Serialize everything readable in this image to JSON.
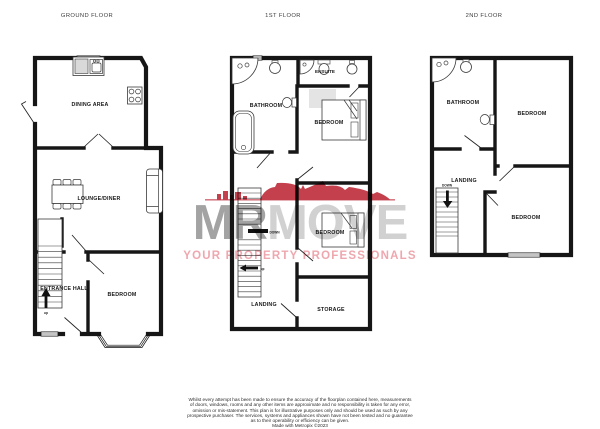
{
  "titles": {
    "ground": "GROUND FLOOR",
    "first": "1ST FLOOR",
    "second": "2ND FLOOR"
  },
  "ground": {
    "dining": "DINING AREA",
    "lounge": "LOUNGE/DINER",
    "hall": "ENTRANCE HALL",
    "bedroom": "BEDROOM",
    "up": "up"
  },
  "first": {
    "bathroom": "BATHROOM",
    "ensuite": "ENSUITE",
    "bedroom_top": "BEDROOM",
    "bedroom_mid": "BEDROOM",
    "landing": "LANDING",
    "storage": "STORAGE",
    "down": "DOWN",
    "up": "up"
  },
  "second": {
    "bathroom": "BATHROOM",
    "bedroom_top": "BEDROOM",
    "landing": "LANDING",
    "bedroom_bottom": "BEDROOM",
    "down": "DOWN"
  },
  "watermark": {
    "brand_left": "MR",
    "brand_right": "MOVE",
    "tagline": "YOUR PROPERTY PROFESSIONALS",
    "accent_color": "#c4404d",
    "brand_left_color": "#a3a3a3",
    "brand_right_color": "#d1d1d1",
    "tagline_color": "#eea7ae"
  },
  "disclaimer": {
    "lines": [
      "Whilst every attempt has been made to ensure the accuracy of the floorplan contained here, measurements",
      "of doors, windows, rooms and any other items are approximate and no responsibility is taken for any error,",
      "omission or mis-statement. This plan is for illustrative purposes only and should be used as such by any",
      "prospective purchaser. The services, systems and appliances shown have not been tested and no guarantee",
      "as to their operability or efficiency can be given."
    ],
    "credit": "Made with Metropix ©2023"
  },
  "colors": {
    "wall": "#161616",
    "background": "#ffffff",
    "furniture_line": "#3a3a3a",
    "worktop_fill": "#d9d9d9",
    "shading_fill": "#e4e4e4"
  }
}
